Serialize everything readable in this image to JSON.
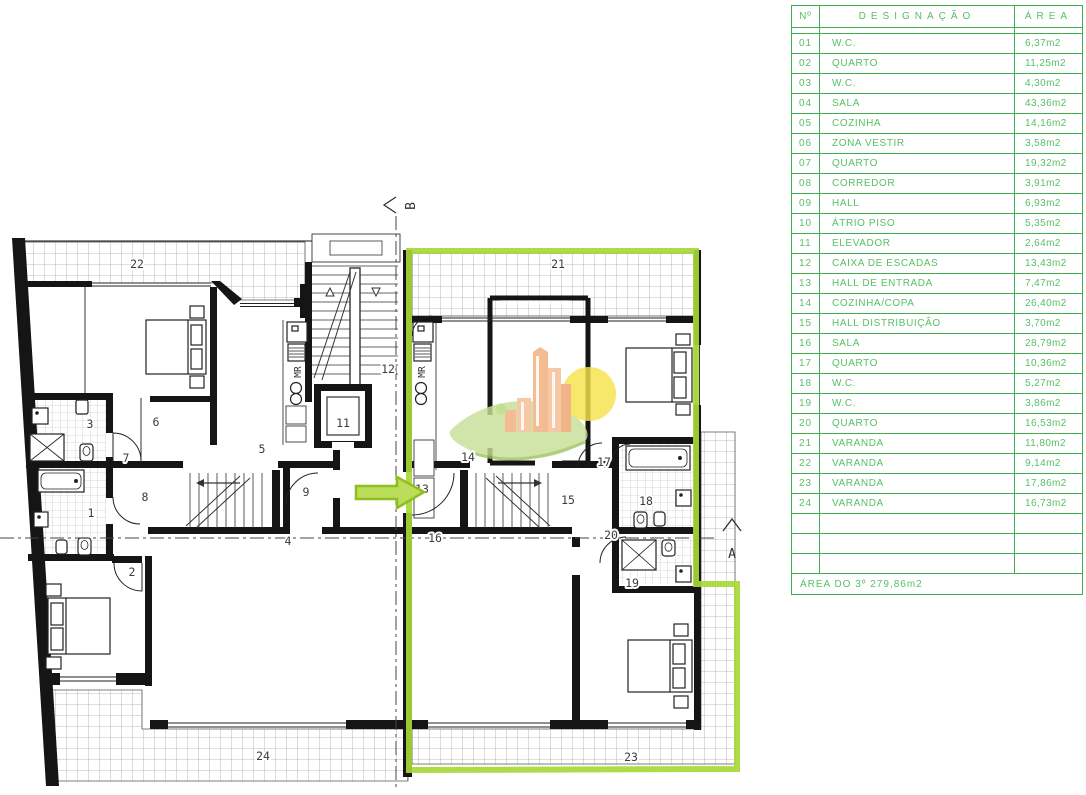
{
  "table": {
    "headers": {
      "no": "Nº",
      "designacao": "DESIGNAÇÃO",
      "area": "ÁREA"
    },
    "rows": [
      {
        "no": "01",
        "name": "W.C.",
        "area": "6,37m2"
      },
      {
        "no": "02",
        "name": "QUARTO",
        "area": "11,25m2"
      },
      {
        "no": "03",
        "name": "W.C.",
        "area": "4,30m2"
      },
      {
        "no": "04",
        "name": "SALA",
        "area": "43,36m2"
      },
      {
        "no": "05",
        "name": "COZINHA",
        "area": "14,16m2"
      },
      {
        "no": "06",
        "name": "ZONA VESTIR",
        "area": "3,58m2"
      },
      {
        "no": "07",
        "name": "QUARTO",
        "area": "19,32m2"
      },
      {
        "no": "08",
        "name": "CORREDOR",
        "area": "3,91m2"
      },
      {
        "no": "09",
        "name": "HALL",
        "area": "6,93m2"
      },
      {
        "no": "10",
        "name": "ÁTRIO PISO",
        "area": "5,35m2"
      },
      {
        "no": "11",
        "name": "ELEVADOR",
        "area": "2,64m2"
      },
      {
        "no": "12",
        "name": "CAIXA DE ESCADAS",
        "area": "13,43m2"
      },
      {
        "no": "13",
        "name": "HALL DE ENTRADA",
        "area": "7,47m2"
      },
      {
        "no": "14",
        "name": "COZINHA/COPA",
        "area": "26,40m2"
      },
      {
        "no": "15",
        "name": "HALL DISTRIBUIÇÃO",
        "area": "3,70m2"
      },
      {
        "no": "16",
        "name": "SALA",
        "area": "28,79m2"
      },
      {
        "no": "17",
        "name": "QUARTO",
        "area": "10,36m2"
      },
      {
        "no": "18",
        "name": "W.C.",
        "area": "5,27m2"
      },
      {
        "no": "19",
        "name": "W.C.",
        "area": "3,86m2"
      },
      {
        "no": "20",
        "name": "QUARTO",
        "area": "16,53m2"
      },
      {
        "no": "21",
        "name": "VARANDA",
        "area": "11,80m2"
      },
      {
        "no": "22",
        "name": "VARANDA",
        "area": "9,14m2"
      },
      {
        "no": "23",
        "name": "VARANDA",
        "area": "17,86m2"
      },
      {
        "no": "24",
        "name": "VARANDA",
        "area": "16,73m2"
      }
    ],
    "empty_row_count": 3,
    "footer": "ÁREA DO 3º  279,86m2"
  },
  "plan": {
    "section_markers": {
      "a": "A",
      "b": "B"
    },
    "appliance_label": "MR",
    "mr_labels": [
      {
        "x": 301,
        "y": 372
      },
      {
        "x": 425,
        "y": 372
      }
    ],
    "room_labels": [
      {
        "text": "22",
        "x": 137,
        "y": 268
      },
      {
        "text": "21",
        "x": 558,
        "y": 268
      },
      {
        "text": "12",
        "x": 388,
        "y": 373
      },
      {
        "text": "11",
        "x": 343,
        "y": 427
      },
      {
        "text": "3",
        "x": 90,
        "y": 428
      },
      {
        "text": "6",
        "x": 156,
        "y": 426
      },
      {
        "text": "5",
        "x": 262,
        "y": 453
      },
      {
        "text": "7",
        "x": 126,
        "y": 462
      },
      {
        "text": "14",
        "x": 468,
        "y": 461
      },
      {
        "text": "17",
        "x": 604,
        "y": 466
      },
      {
        "text": "8",
        "x": 145,
        "y": 501
      },
      {
        "text": "9",
        "x": 306,
        "y": 496
      },
      {
        "text": "10",
        "x": 361,
        "y": 497
      },
      {
        "text": "13",
        "x": 422,
        "y": 493
      },
      {
        "text": "15",
        "x": 568,
        "y": 504
      },
      {
        "text": "18",
        "x": 646,
        "y": 505
      },
      {
        "text": "1",
        "x": 91,
        "y": 517
      },
      {
        "text": "20",
        "x": 611,
        "y": 539
      },
      {
        "text": "16",
        "x": 435,
        "y": 542
      },
      {
        "text": "4",
        "x": 288,
        "y": 545
      },
      {
        "text": "2",
        "x": 132,
        "y": 576
      },
      {
        "text": "19",
        "x": 632,
        "y": 587
      },
      {
        "text": "23",
        "x": 631,
        "y": 761
      },
      {
        "text": "24",
        "x": 263,
        "y": 760
      }
    ]
  },
  "colors": {
    "table_green": "#3eb04b",
    "table_text_green": "#56c163",
    "highlight_green": "#a9d838",
    "arrow_fill": "#bade59",
    "logo_orange": "#f2ae7c",
    "logo_yellow": "#f6e24b",
    "logo_leaf": "#c8df98"
  }
}
